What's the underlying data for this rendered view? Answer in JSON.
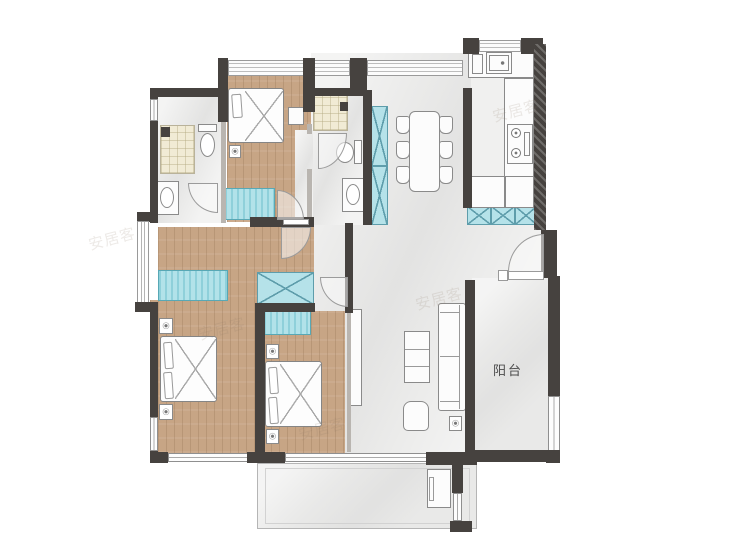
{
  "labels": {
    "balcony": "阳台"
  },
  "watermark": {
    "text": "安居客"
  },
  "colors": {
    "wall": "#46423f",
    "wood_floor": "#c7a585",
    "tile_floor": "#ebebea",
    "teal_cabinet": "#b2e2e9",
    "teal_stripe": "#8fd0da",
    "shower_mat": "#f1ebd5",
    "furniture_outline": "#8a8a8a",
    "label_text": "#4c4c4c"
  },
  "rooms": [
    {
      "name": "bathroom-1"
    },
    {
      "name": "bedroom-1"
    },
    {
      "name": "bathroom-2"
    },
    {
      "name": "dining-area"
    },
    {
      "name": "kitchen"
    },
    {
      "name": "entry-foyer"
    },
    {
      "name": "dressing-area"
    },
    {
      "name": "master-bedroom"
    },
    {
      "name": "bedroom-2"
    },
    {
      "name": "living-room"
    },
    {
      "name": "balcony",
      "label": "阳台"
    },
    {
      "name": "lower-balcony"
    }
  ],
  "fixtures": [
    "shower",
    "toilet",
    "vanity-sink",
    "kitchen-sink",
    "stove",
    "washer",
    "bed",
    "nightstand-plant",
    "wardrobe",
    "dining-table",
    "chair",
    "sofa",
    "armchair",
    "coffee-table",
    "tv-console",
    "door-swing",
    "window"
  ]
}
